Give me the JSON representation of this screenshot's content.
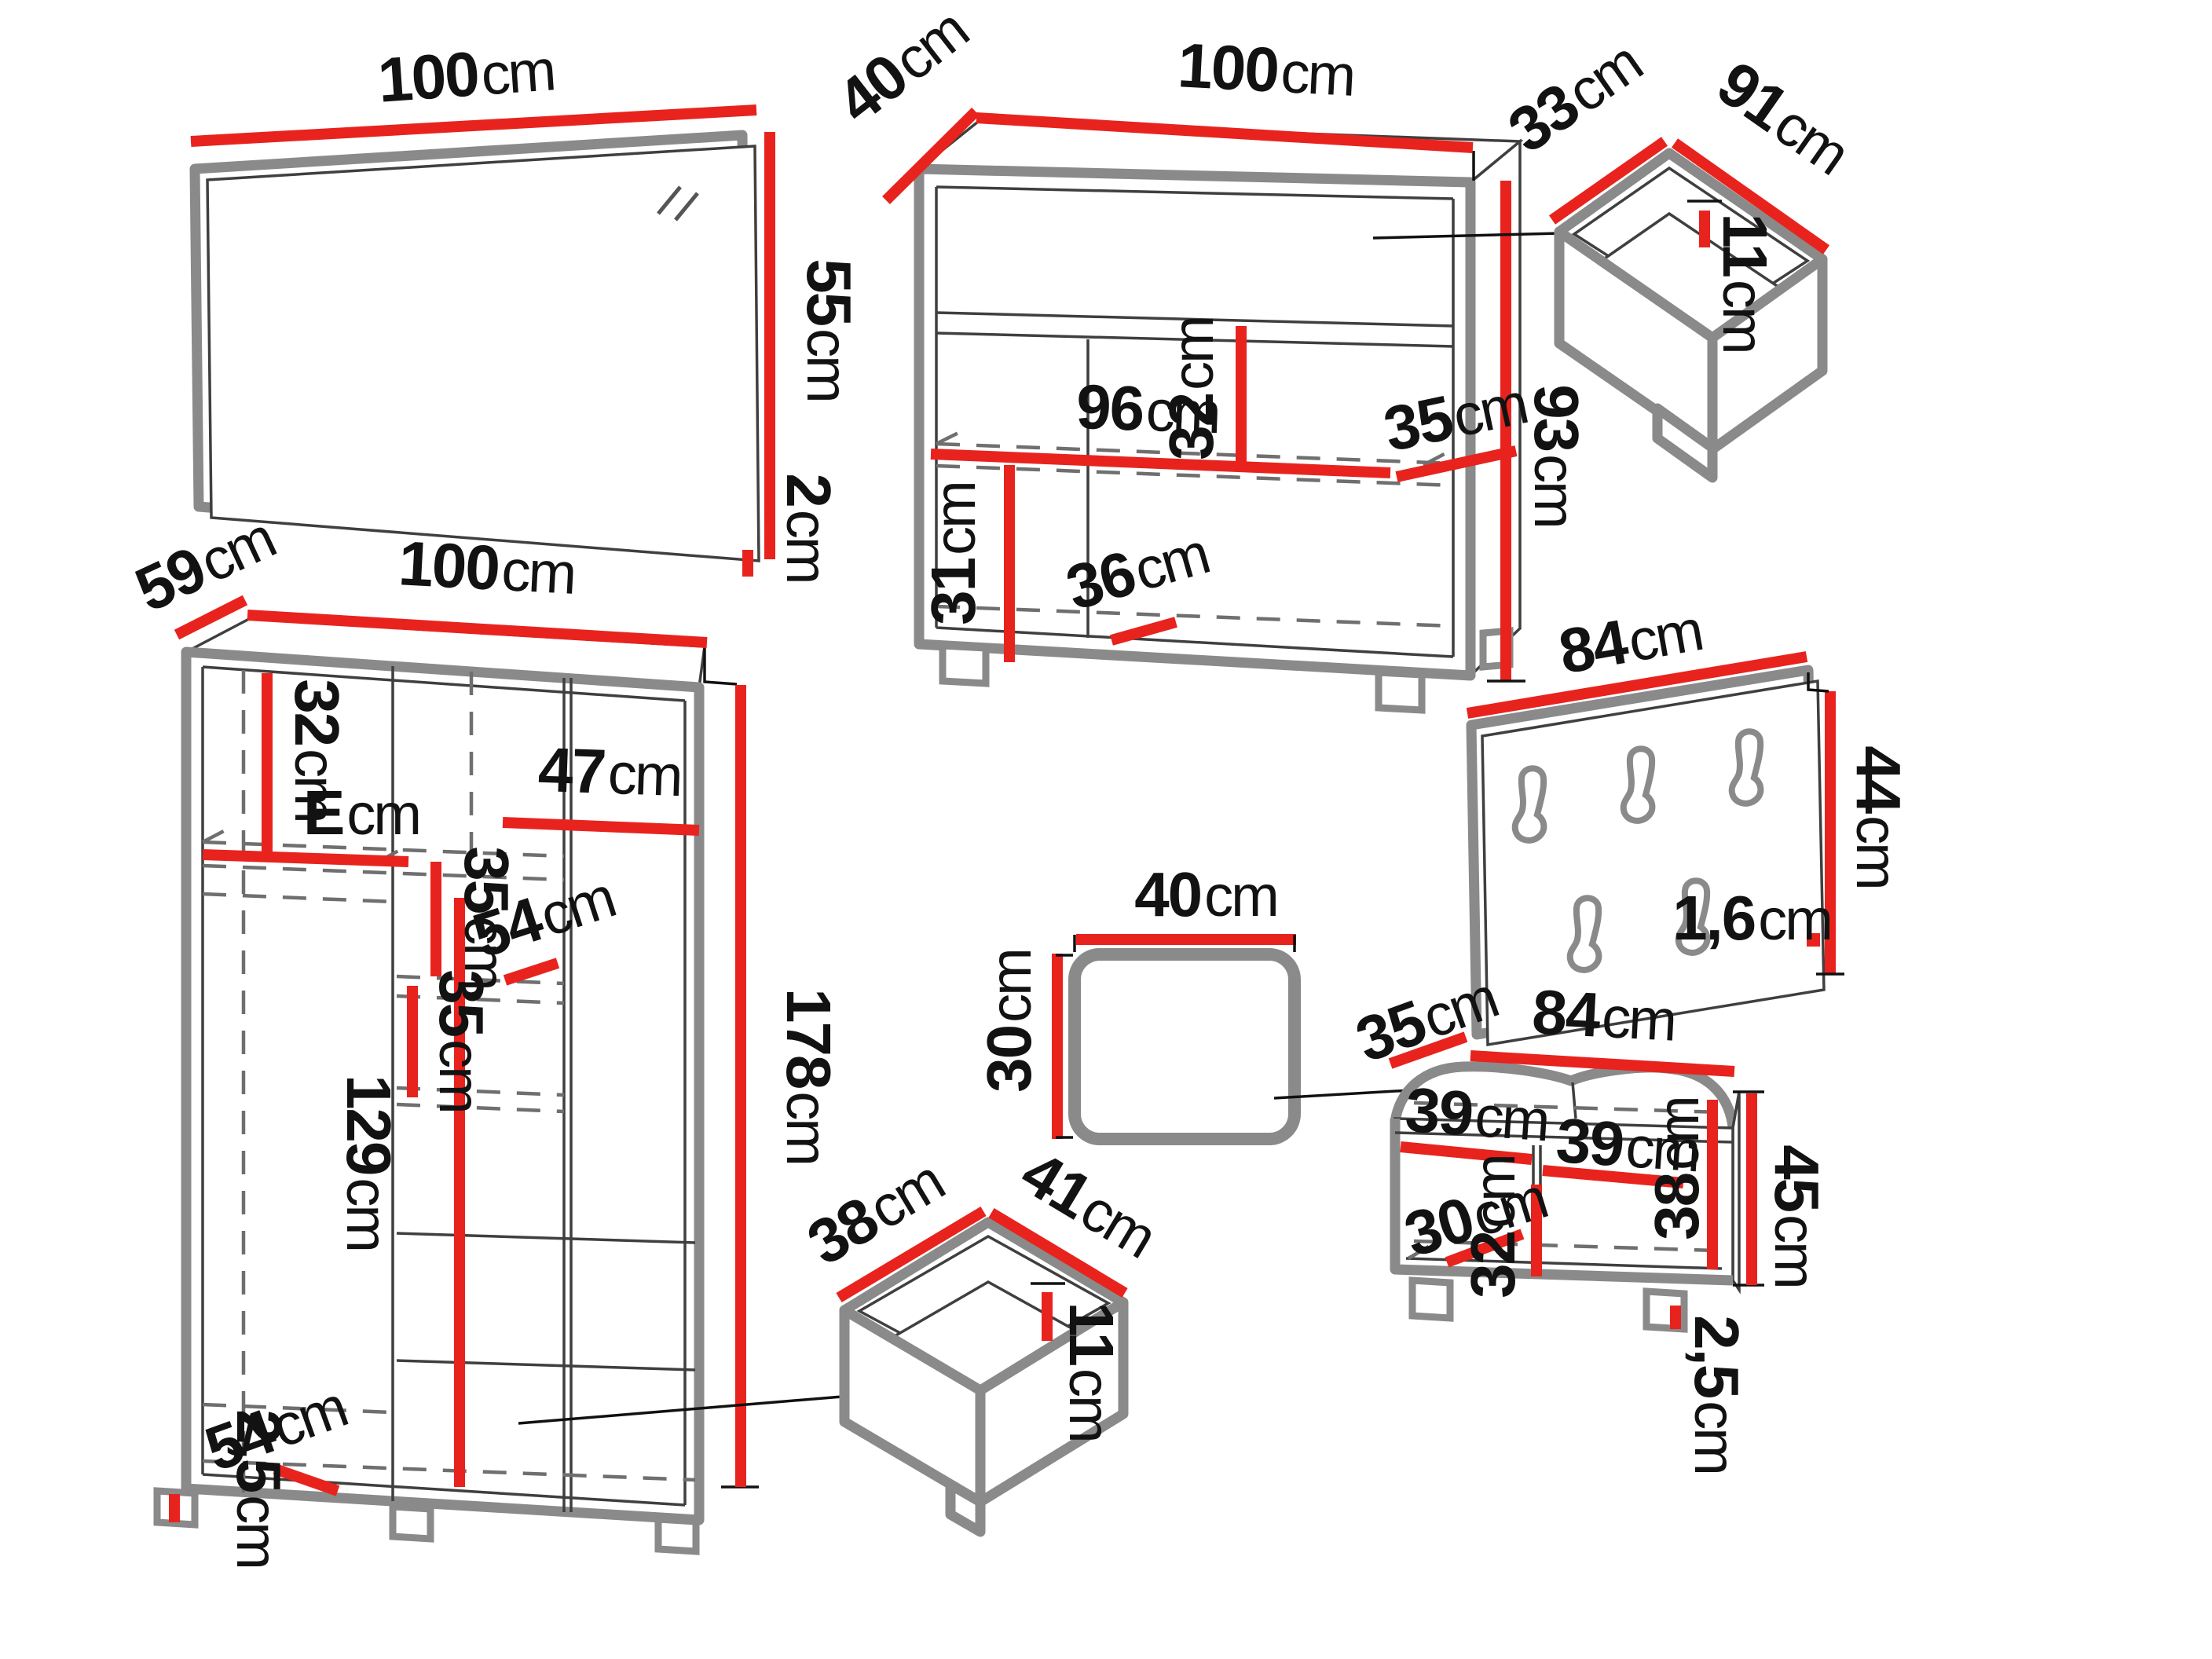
{
  "unit": "cm",
  "palette": {
    "dimension_red": "#e8231e",
    "furniture_gray": "#8a8a8a",
    "text_black": "#121212",
    "background": "#ffffff"
  },
  "mirror": {
    "width": "100",
    "height": "55",
    "thickness": "2"
  },
  "sideboard": {
    "depth": "40",
    "width": "100",
    "height": "93",
    "inner_width": "96",
    "upper_section_height": "32",
    "shelf_depth": "35",
    "lower_section_height": "31",
    "bottom_depth": "36",
    "leg_height": "2,5"
  },
  "top_drawer": {
    "depth": "33",
    "width": "91",
    "height": "11"
  },
  "coat_rack": {
    "width": "84",
    "height": "44",
    "thickness": "1,6",
    "hook_count": 5
  },
  "wardrobe": {
    "depth": "59",
    "width": "100",
    "upper_section_height": "32",
    "upper_shelf_width": "E",
    "right_shelf_width": "47",
    "shelf_spacing_upper": "35",
    "shelf_depth": "54",
    "shelf_spacing_lower": "35",
    "hanging_space_height": "129",
    "height": "178",
    "leg_height": "2,5",
    "bottom_shelf_depth": "54"
  },
  "stool": {
    "width": "40",
    "height": "30"
  },
  "small_drawer": {
    "depth": "38",
    "width": "41",
    "height": "11"
  },
  "bench": {
    "depth": "35",
    "width": "84",
    "left_compartment_width": "39",
    "right_compartment_width": "39",
    "inner_height": "38",
    "divider_height": "32",
    "inner_depth": "30",
    "height": "45",
    "leg_height": "2,5"
  }
}
